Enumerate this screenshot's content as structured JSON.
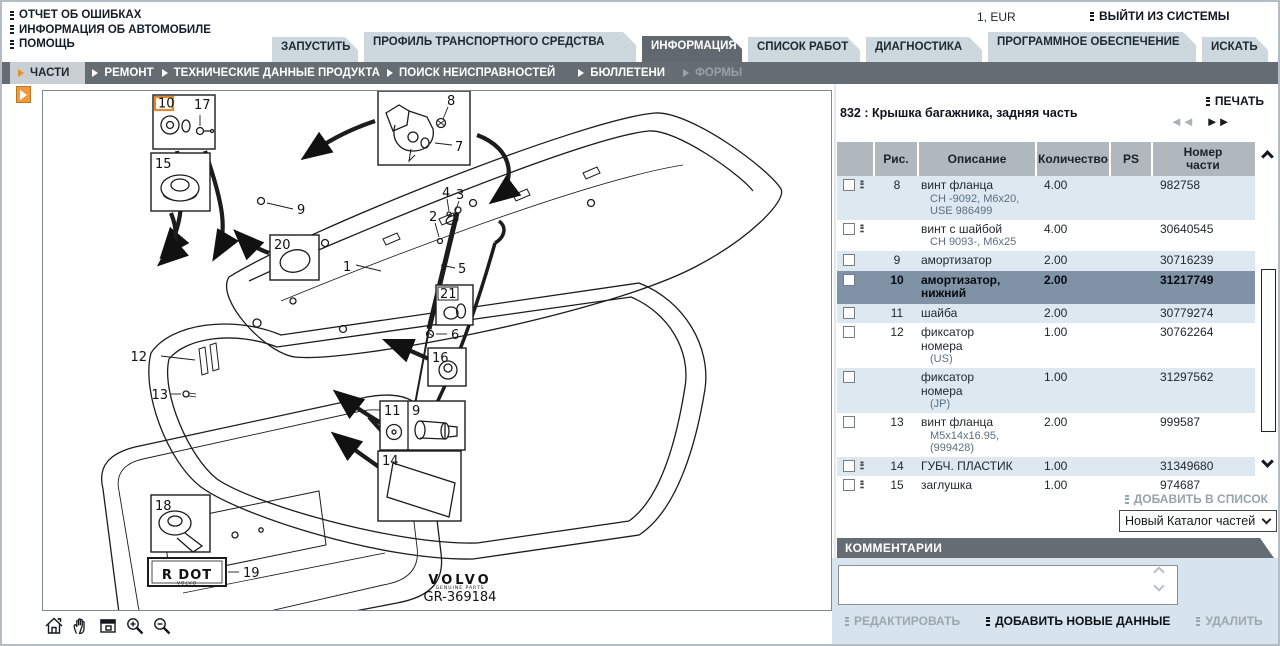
{
  "header": {
    "links": [
      "ОТЧЕТ ОБ ОШИБКАХ",
      "ИНФОРМАЦИЯ ОБ АВТОМОБИЛЕ",
      "ПОМОЩЬ"
    ],
    "currency": "1, EUR",
    "logout": "ВЫЙТИ ИЗ СИСТЕМЫ"
  },
  "tabs": [
    {
      "label": "ЗАПУСТИТЬ",
      "active": false,
      "two_line": false
    },
    {
      "label": "ПРОФИЛЬ ТРАНСПОРТНОГО СРЕДСТВА",
      "active": false,
      "two_line": true
    },
    {
      "label": "ИНФОРМАЦИЯ",
      "active": true,
      "two_line": false
    },
    {
      "label": "СПИСОК РАБОТ",
      "active": false,
      "two_line": false
    },
    {
      "label": "ДИАГНОСТИКА",
      "active": false,
      "two_line": false
    },
    {
      "label": "ПРОГРАММНОЕ ОБЕСПЕЧЕНИЕ",
      "active": false,
      "two_line": true
    },
    {
      "label": "ИСКАТЬ",
      "active": false,
      "two_line": false
    }
  ],
  "subnav": [
    {
      "label": "ЧАСТИ",
      "state": "active"
    },
    {
      "label": "РЕМОНТ",
      "state": "normal"
    },
    {
      "label": "ТЕХНИЧЕСКИЕ ДАННЫЕ ПРОДУКТА",
      "state": "normal"
    },
    {
      "label": "ПОИСК НЕИСПРАВНОСТЕЙ",
      "state": "normal"
    },
    {
      "label": "БЮЛЛЕТЕНИ",
      "state": "normal"
    },
    {
      "label": "ФОРМЫ",
      "state": "disabled"
    }
  ],
  "parts": {
    "print_label": "ПЕЧАТЬ",
    "title": "832 : Крышка багажника, задняя часть",
    "pager_prev": "◄◄",
    "pager_next": "►►",
    "headers": [
      "",
      "Рис.",
      "Описание",
      "Количество",
      "PS",
      "Номер\nчасти"
    ],
    "rows": [
      {
        "fig": "8",
        "desc": "винт фланца",
        "sub": "CH -9092, M6x20, USE 986499",
        "qty": "4.00",
        "ps": "",
        "num": "982758",
        "icon": true,
        "selected": false
      },
      {
        "fig": "",
        "desc": "винт с шайбой",
        "sub": "CH 9093-, M6x25",
        "qty": "4.00",
        "ps": "",
        "num": "30640545",
        "icon": true,
        "selected": false
      },
      {
        "fig": "9",
        "desc": "амортизатор",
        "sub": "",
        "qty": "2.00",
        "ps": "",
        "num": "30716239",
        "icon": false,
        "selected": false
      },
      {
        "fig": "10",
        "desc": "амортизатор,\nнижний",
        "sub": "",
        "qty": "2.00",
        "ps": "",
        "num": "31217749",
        "icon": false,
        "selected": true
      },
      {
        "fig": "11",
        "desc": "шайба",
        "sub": "",
        "qty": "2.00",
        "ps": "",
        "num": "30779274",
        "icon": false,
        "selected": false
      },
      {
        "fig": "12",
        "desc": "фиксатор\nномера",
        "sub": "(US)",
        "qty": "1.00",
        "ps": "",
        "num": "30762264",
        "icon": false,
        "selected": false
      },
      {
        "fig": "",
        "desc": "фиксатор\nномера",
        "sub": "(JP)",
        "qty": "1.00",
        "ps": "",
        "num": "31297562",
        "icon": false,
        "selected": false
      },
      {
        "fig": "13",
        "desc": "винт фланца",
        "sub": "M5x14x16.95, (999428)",
        "qty": "2.00",
        "ps": "",
        "num": "999587",
        "icon": false,
        "selected": false
      },
      {
        "fig": "14",
        "desc": "ГУБЧ. ПЛАСТИК",
        "sub": "",
        "qty": "1.00",
        "ps": "",
        "num": "31349680",
        "icon": true,
        "selected": false
      },
      {
        "fig": "15",
        "desc": "заглушка",
        "sub": "",
        "qty": "1.00",
        "ps": "",
        "num": "974687",
        "icon": true,
        "selected": false
      },
      {
        "fig": "16",
        "desc": "заглушка",
        "sub": "",
        "qty": "1.00",
        "ps": "",
        "num": "974683",
        "icon": true,
        "selected": false
      },
      {
        "fig": "17",
        "desc": "винт",
        "sub": "",
        "qty": "2.00",
        "ps": "",
        "num": "31218731",
        "icon": false,
        "selected": false
      }
    ],
    "add_to_list": "ДОБАВИТЬ В СПИСОК",
    "catalog_select": "Новый Каталог частей",
    "comments_title": "КОММЕНТАРИИ",
    "comment_value": "",
    "buttons": [
      {
        "label": "РЕДАКТИРОВАТЬ",
        "enabled": false
      },
      {
        "label": "ДОБАВИТЬ НОВЫЕ ДАННЫЕ",
        "enabled": true
      },
      {
        "label": "УДАЛИТЬ",
        "enabled": false
      }
    ]
  },
  "diagram": {
    "highlighted": "10",
    "c1": "1",
    "c2": "2",
    "c3": "3",
    "c4": "4",
    "c5": "5",
    "c6": "6",
    "c7": "7",
    "c8": "8",
    "c9": "9",
    "c10": "10",
    "c11": "11",
    "c12": "12",
    "c13": "13",
    "c14": "14",
    "c15": "15",
    "c16": "16",
    "c17": "17",
    "c18": "18",
    "c19": "19",
    "c20": "20",
    "c21": "21",
    "rdot": "R DOT",
    "rdot_sub": "VOLVO",
    "brand": "VOLVO",
    "brand_sub": "GENUINE PARTS",
    "ref": "GR-369184"
  }
}
